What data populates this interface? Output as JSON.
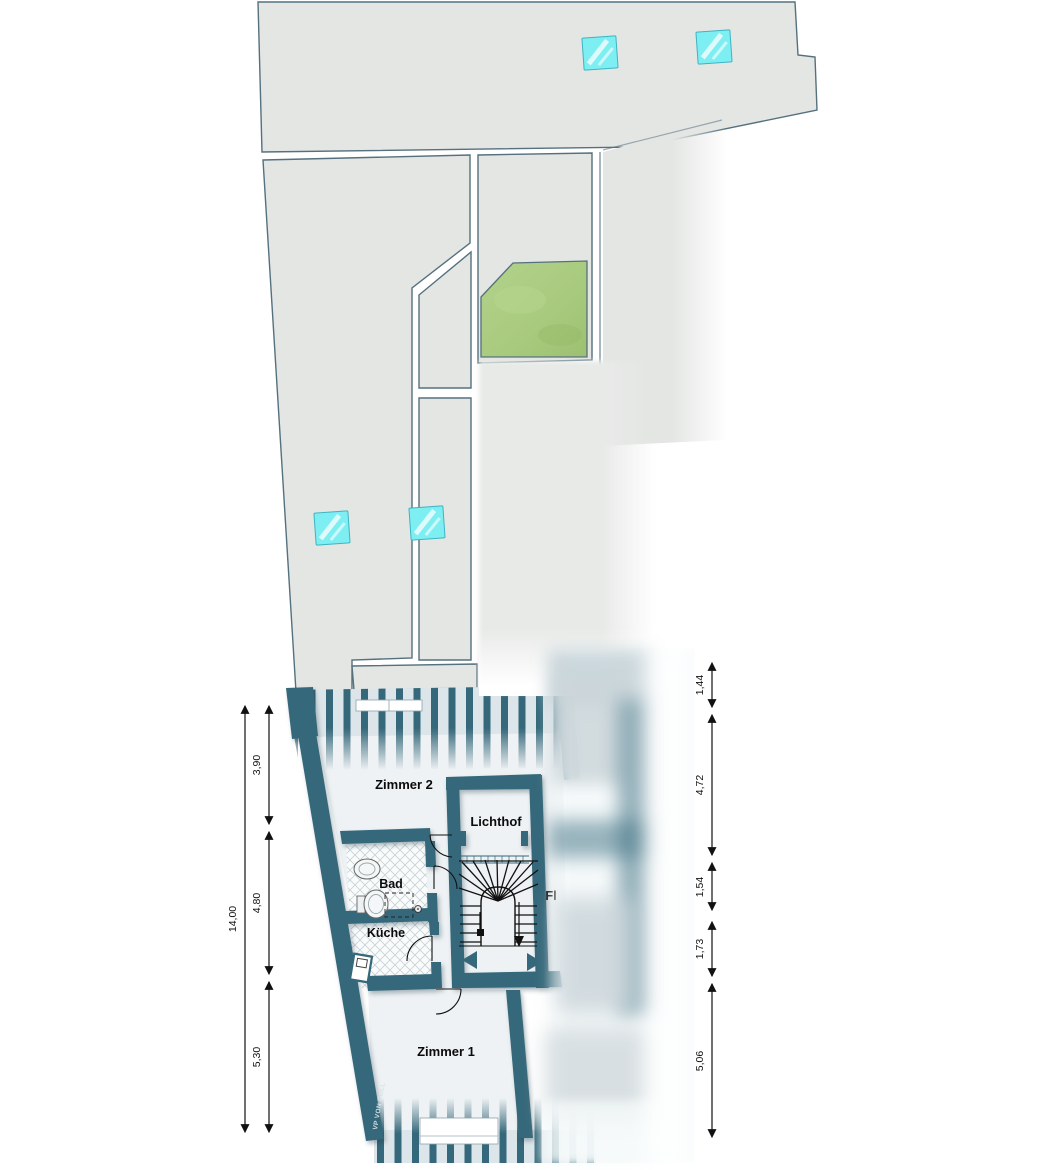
{
  "plan": {
    "labels": {
      "zimmer2": "Zimmer 2",
      "lichthof": "Lichthof",
      "bad": "Bad",
      "kueche": "Küche",
      "zimmer1": "Zimmer 1",
      "flur": "Fl"
    },
    "watermark": "VP VON POLL",
    "dims": {
      "left_total": "14,00",
      "left": [
        "3,90",
        "4,80",
        "5,30"
      ],
      "right": [
        "1,44",
        "4,72",
        "1,54",
        "1,73",
        "5,06"
      ]
    },
    "colors": {
      "wall_teal": "#35687a",
      "site_gray": "#e4e6e4",
      "site_stroke": "#55707e",
      "lawn_green": "#a8ca7e",
      "skylight_cyan": "#7deef2",
      "room_fill": "#eef2f4",
      "dimension_black": "#111111"
    },
    "icons": {
      "skylight": "skylight-icon",
      "sink": "sink-icon",
      "toilet": "toilet-icon",
      "stair_direction": "stair-direction-arrow-icon",
      "hall_left": "hall-arrow-left-icon",
      "hall_right": "hall-arrow-right-icon"
    }
  }
}
